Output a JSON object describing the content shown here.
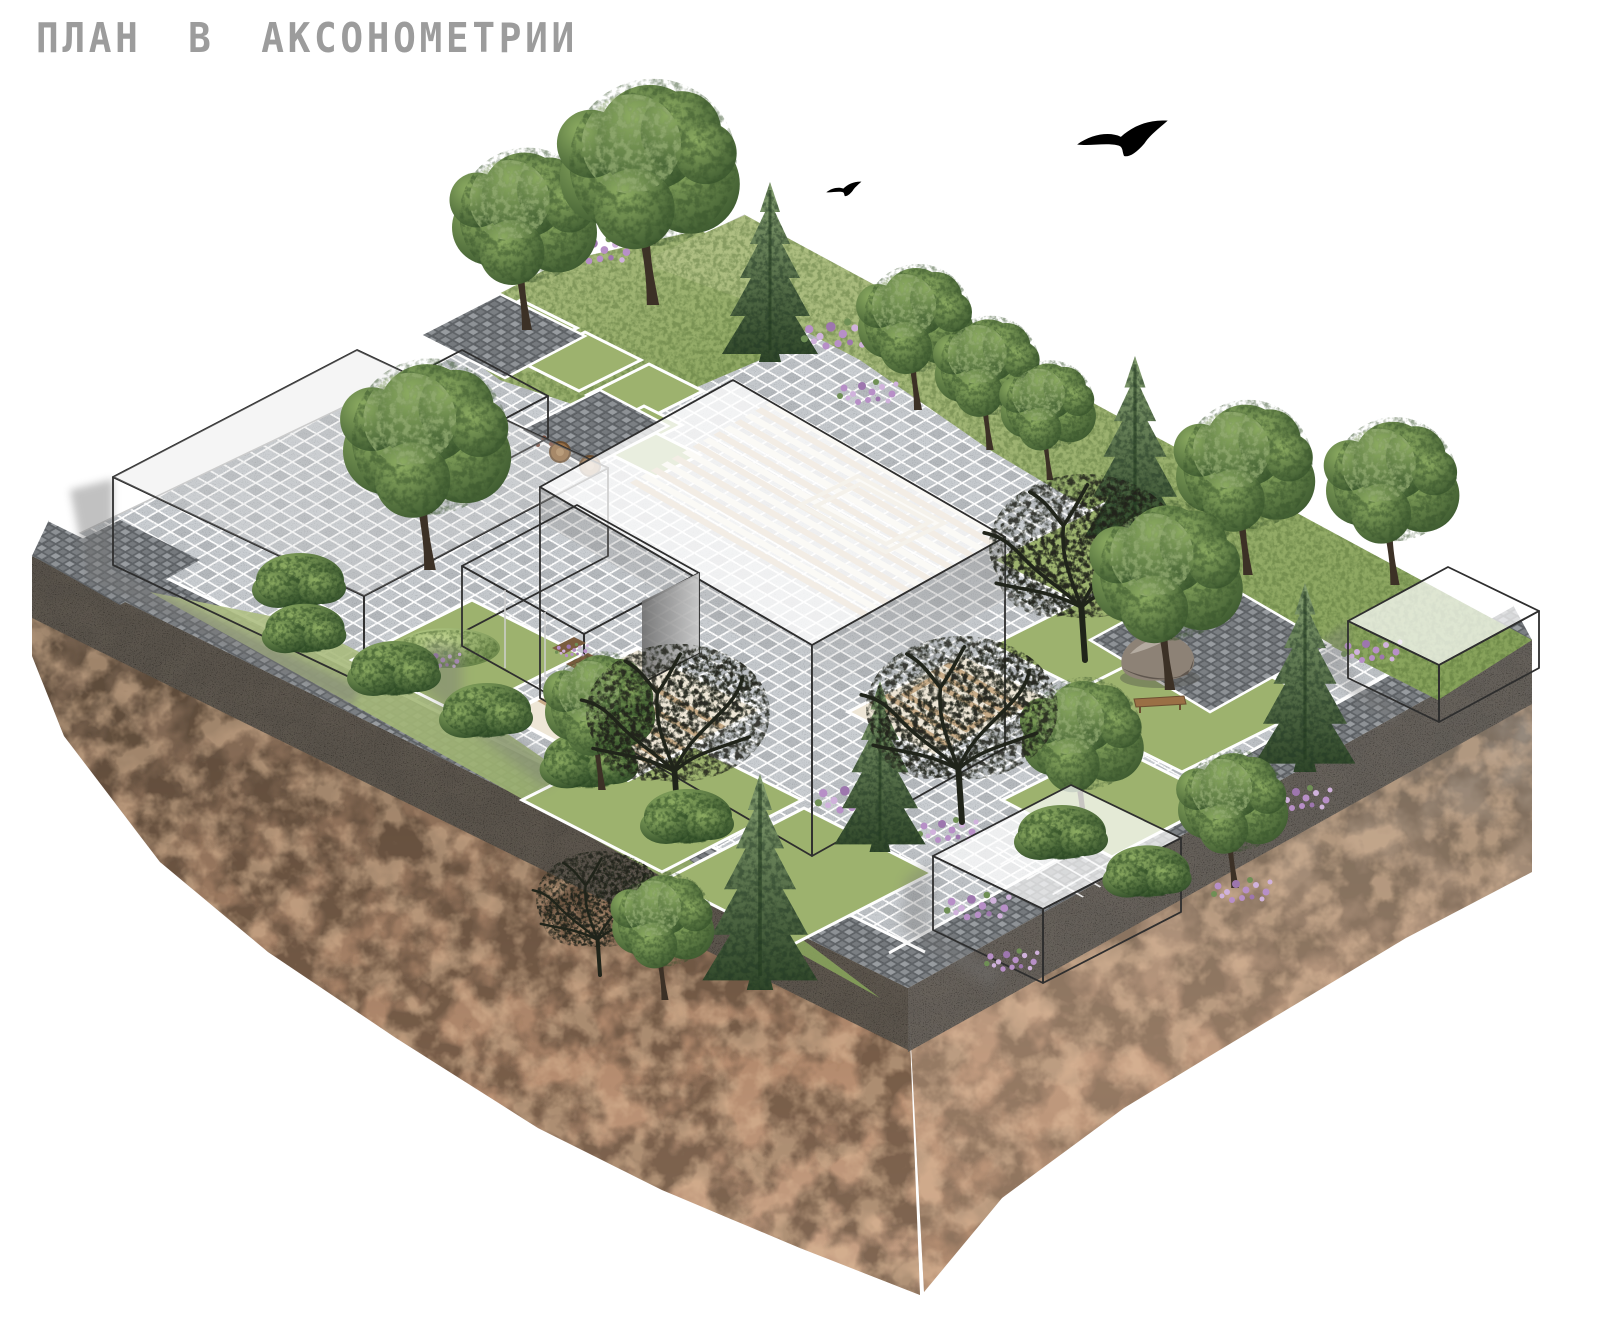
{
  "title": "ПЛАН В АКСОНОМЕТРИИ",
  "scene": {
    "kind": "axonometric landscape site plan on a floating soil cross-section block",
    "sky": "white",
    "birds": [
      "large bird silhouette",
      "small bird silhouette"
    ],
    "buildings": {
      "west_long_building": "long white box at west corner",
      "west_annex": "low white box behind the long building",
      "central_building": "large translucent white volume with lower front wing and timber floor visible through roof",
      "east_pavilion": "small translucent white box on the east corner",
      "south_pavilion": "small translucent white box on the south edge"
    },
    "landscape": {
      "paving": "light grey stone sett plaza",
      "lawns": "green lawn squares edged by white paths",
      "gravel": "grey pebble strips along the plot edges and feature patches",
      "decks": "timber deck strips and nested chevron steps",
      "features": [
        "boulder on gravel patch",
        "wooden bench",
        "two round timber stools",
        "flower planters"
      ],
      "planting": [
        "deciduous trees",
        "spruce trees",
        "black silhouette trees",
        "hedges and bushes",
        "purple flower patches"
      ]
    },
    "soil_block": {
      "top_band": "dark grey crushed stone layer",
      "body": "brown and pink-tan rocky earth, jagged bottom edge"
    }
  },
  "colors": {
    "background": "#ffffff",
    "title_gray": "#9c9c9c",
    "building_fill": "#ffffff",
    "building_edge": "#2e2e2e",
    "paving": "#c4c8cc",
    "paving_dark": "#b4b8bc",
    "gravel": "#7d8185",
    "gravel_dark": "#5f6367",
    "lawn": "#9db26e",
    "grass": "#84a058",
    "grass_light": "#b2c186",
    "foliage_light": "#8fae63",
    "foliage": "#55753f",
    "foliage_dark": "#36512a",
    "conifer_light": "#86a071",
    "conifer": "#2f4629",
    "dark_tree": "#20241a",
    "flower": "#b78fc7",
    "flower_light": "#d0b2dc",
    "wood": "#c7ab87",
    "wood_light": "#eee6d6",
    "soil_top_band": "#57524b",
    "soil_brown": "#8a6a52",
    "soil_tan": "#c19b7f",
    "bird": "#000000"
  }
}
